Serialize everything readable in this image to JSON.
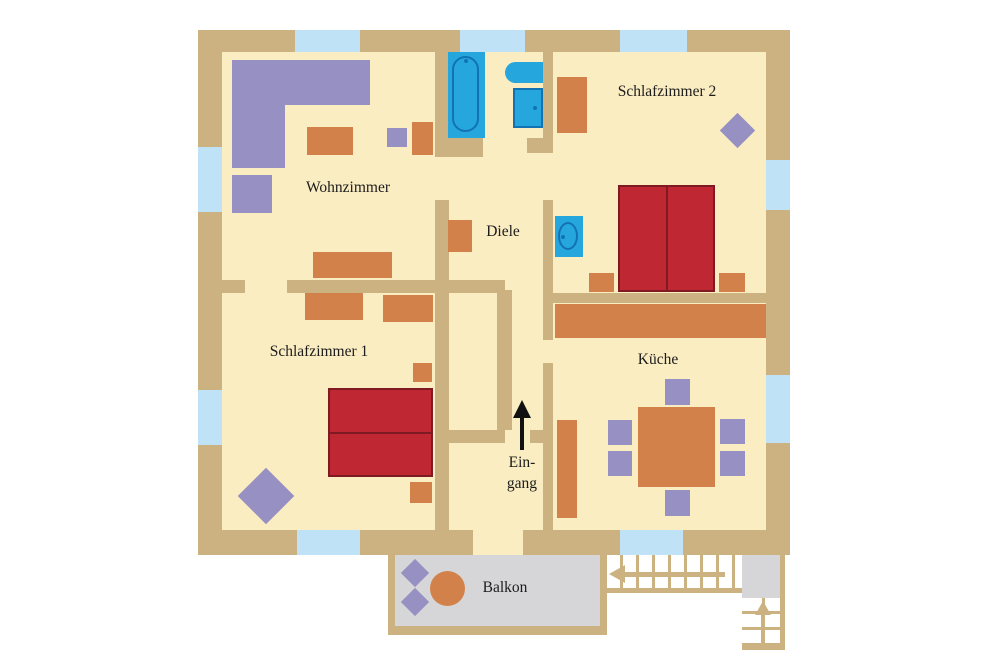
{
  "title": "Apartment floor plan (German labels)",
  "labels": {
    "wohnzimmer": "Wohnzimmer",
    "diele": "Diele",
    "schlafzimmer2": "Schlafzimmer 2",
    "schlafzimmer1": "Schlafzimmer 1",
    "kueche": "Küche",
    "eingang_line1": "Ein-",
    "eingang_line2": "gang",
    "balkon": "Balkon"
  },
  "colors": {
    "wall": "#cbb280",
    "floor": "#fbedc2",
    "window": "#bfe2f6",
    "purple": "#9790c2",
    "orange": "#d2814b",
    "bed": "#bf2733",
    "bedBorder": "#7f1a22",
    "bath": "#25a7dd",
    "bathLine": "#1272b4",
    "balcony": "#d6d6d8",
    "text": "#1c1c1c",
    "arrow": "#111111"
  },
  "icons": [
    "sofa-icon",
    "armchair-icon",
    "coffee-table-icon",
    "bathtub-icon",
    "sink-icon",
    "washing-machine-icon",
    "double-bed-icon",
    "nightstand-icon",
    "wardrobe-icon",
    "kitchen-counter-icon",
    "dining-table-icon",
    "chair-icon",
    "plant-diamond-icon",
    "entrance-arrow-icon",
    "stairs-icon",
    "balcony-table-icon"
  ]
}
